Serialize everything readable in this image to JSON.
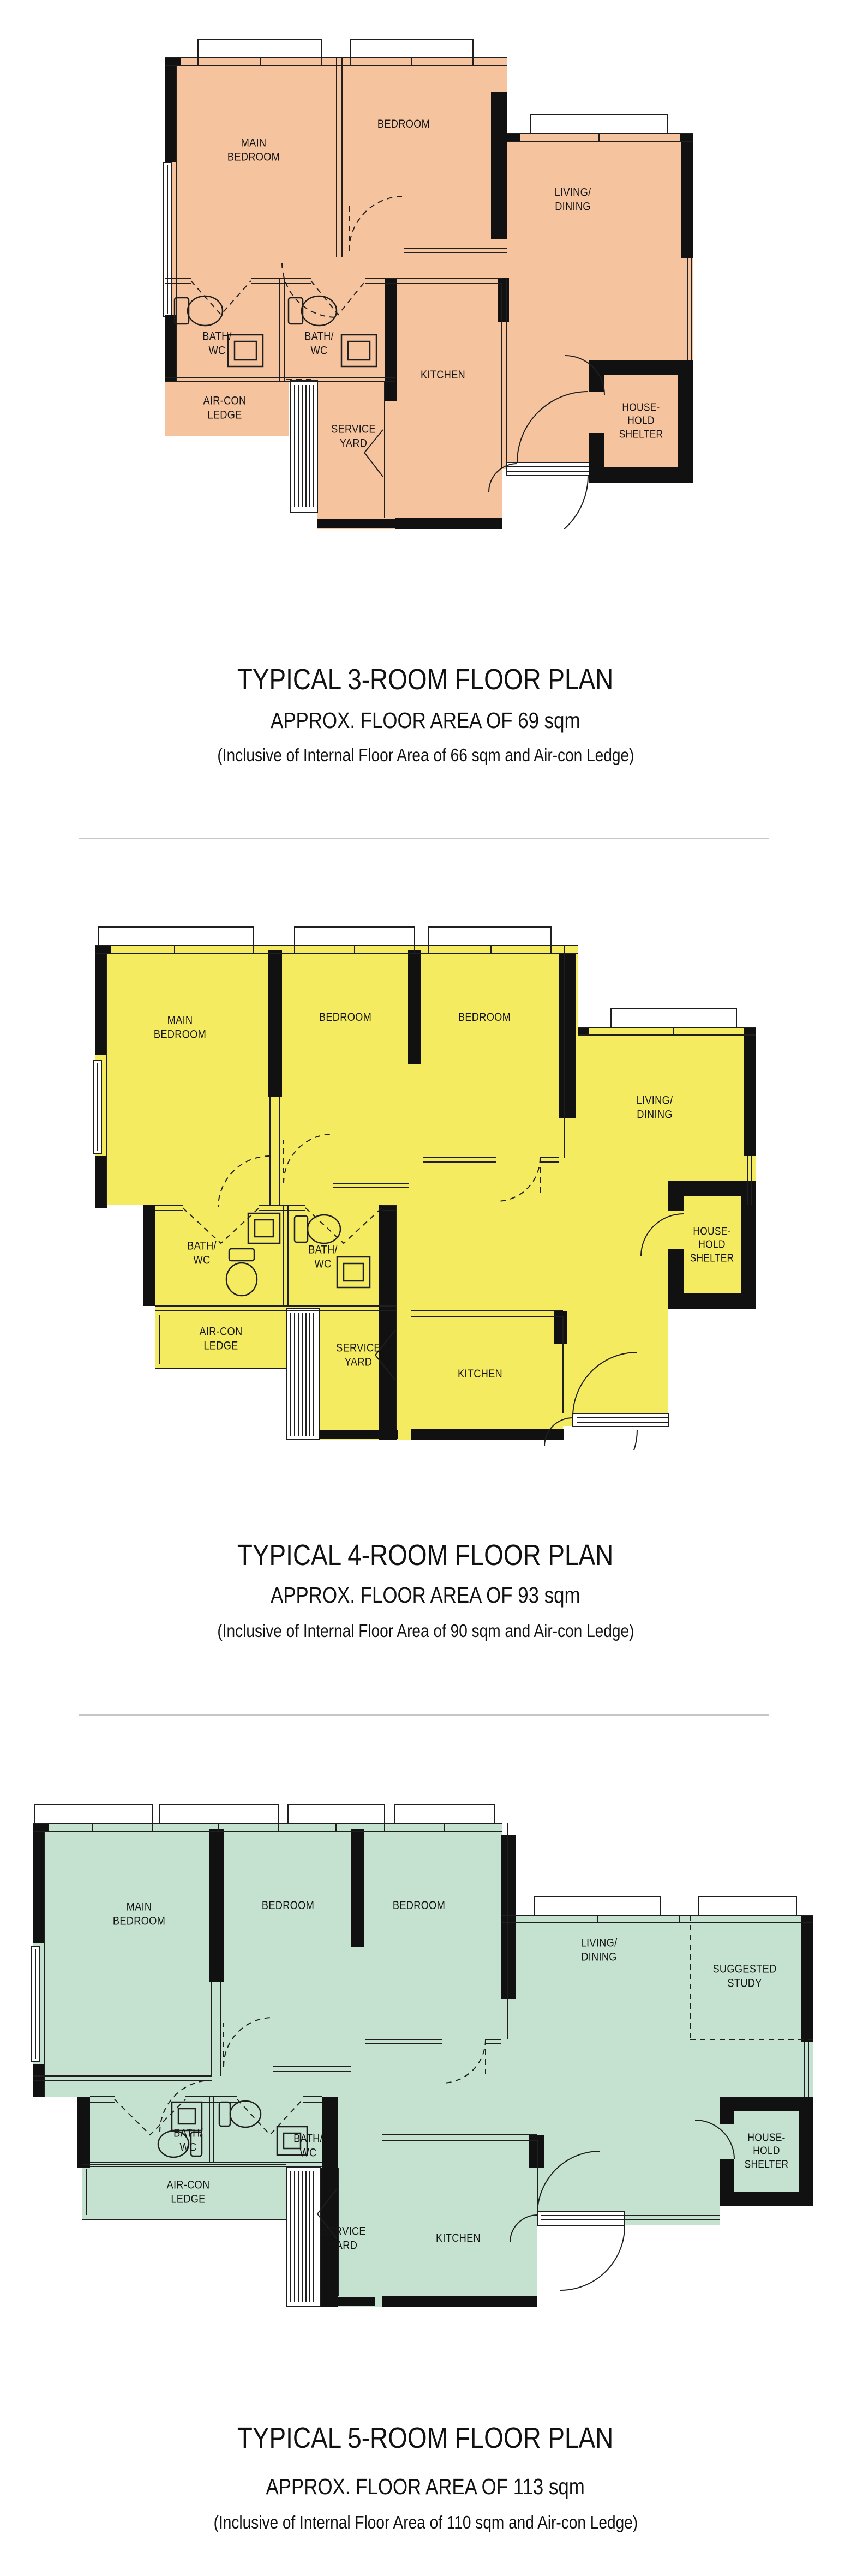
{
  "wall_color": "#111111",
  "plans": [
    {
      "name": "3-room",
      "color": "#F5C49F",
      "title": "TYPICAL 3-ROOM FLOOR PLAN",
      "area": "APPROX. FLOOR AREA OF 69 sqm",
      "inclusive": "(Inclusive of Internal Floor Area of 66 sqm and Air-con Ledge)",
      "labels": {
        "main_bedroom": "MAIN\nBEDROOM",
        "bedroom": "BEDROOM",
        "living_dining": "LIVING/\nDINING",
        "bath_1": "BATH/\nWC",
        "bath_2": "BATH/\nWC",
        "aircon_ledge": "AIR-CON\nLEDGE",
        "service_yard": "SERVICE\nYARD",
        "kitchen": "KITCHEN",
        "household_shelter": "HOUSE-\nHOLD\nSHELTER"
      }
    },
    {
      "name": "4-room",
      "color": "#F5EB61",
      "title": "TYPICAL 4-ROOM FLOOR PLAN",
      "area": "APPROX. FLOOR AREA OF 93 sqm",
      "inclusive": "(Inclusive of Internal Floor Area of 90 sqm and Air-con Ledge)",
      "labels": {
        "main_bedroom": "MAIN\nBEDROOM",
        "bedroom_1": "BEDROOM",
        "bedroom_2": "BEDROOM",
        "living_dining": "LIVING/\nDINING",
        "bath_1": "BATH/\nWC",
        "bath_2": "BATH/\nWC",
        "aircon_ledge": "AIR-CON\nLEDGE",
        "service_yard": "SERVICE\nYARD",
        "kitchen": "KITCHEN",
        "household_shelter": "HOUSE-\nHOLD\nSHELTER"
      }
    },
    {
      "name": "5-room",
      "color": "#C5E1D0",
      "title": "TYPICAL 5-ROOM FLOOR PLAN",
      "area": "APPROX. FLOOR AREA OF 113 sqm",
      "inclusive": "(Inclusive of Internal Floor Area of 110 sqm and Air-con Ledge)",
      "labels": {
        "main_bedroom": "MAIN\nBEDROOM",
        "bedroom_1": "BEDROOM",
        "bedroom_2": "BEDROOM",
        "living_dining": "LIVING/\nDINING",
        "suggested_study": "SUGGESTED\nSTUDY",
        "bath_1": "BATH/\nWC",
        "bath_2": "BATH/\nWC",
        "aircon_ledge": "AIR-CON\nLEDGE",
        "service_yard": "SERVICE\nYARD",
        "kitchen": "KITCHEN",
        "household_shelter": "HOUSE-\nHOLD\nSHELTER"
      }
    }
  ]
}
